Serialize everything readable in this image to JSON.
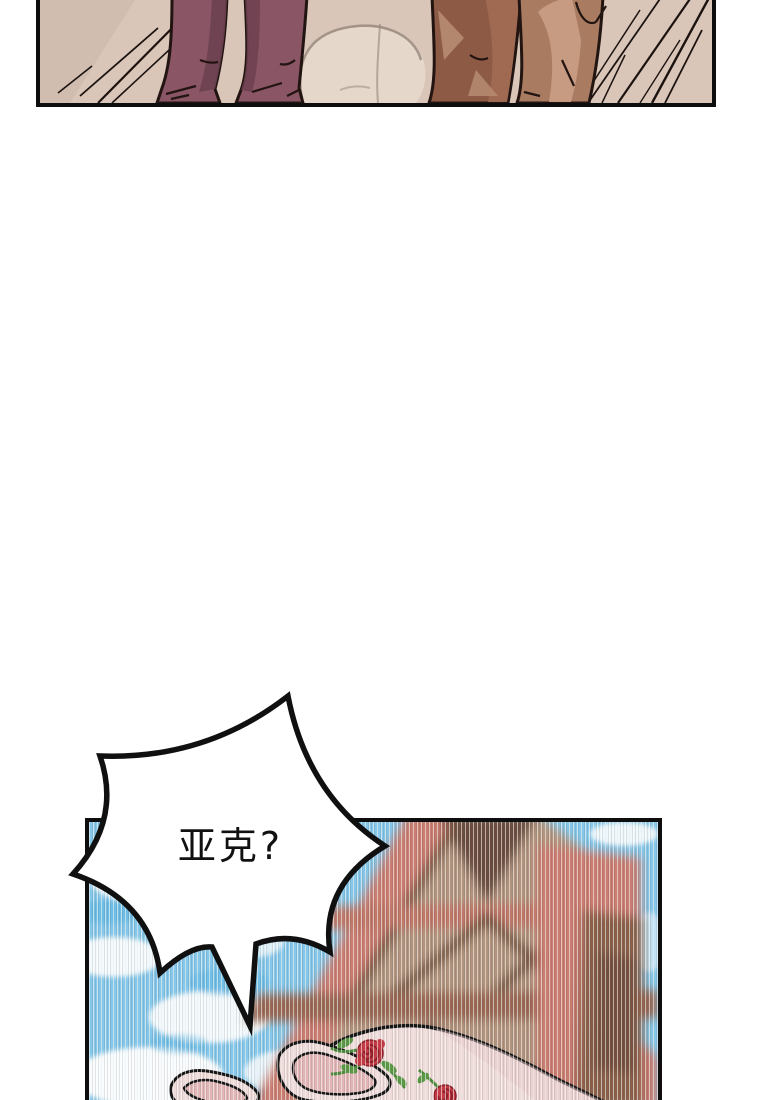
{
  "page": {
    "kind": "webtoon comic page",
    "background": "#ffffff"
  },
  "speech_bubble": {
    "text": "亚克?",
    "shape": "spiky-burst",
    "fill": "#ffffff",
    "stroke": "#101010",
    "text_color": "#111111"
  },
  "panels": {
    "top": {
      "description": "legs of two characters standing on a stone street with speed lines",
      "border_color": "#0e0e0e",
      "colors": {
        "ground": "#d9c6b9",
        "ground_shade": "#cbb6a8",
        "stone_light": "#e7d8cb",
        "crack": "#95867a",
        "outline": "#221411",
        "left_pants": "#8a5565",
        "left_pants_shadow": "#6c4150",
        "right_leg_front": "#8d5a45",
        "right_leg_front_light": "#a06b52",
        "right_leg_back": "#a97c62",
        "right_leg_highlight": "#c79d83",
        "speed_line": "#1c1310"
      }
    },
    "bottom": {
      "description": "blue sky, blurred half-timbered gable roof, rose-patterned bonnet",
      "border_color": "#0e0e0e",
      "colors": {
        "sky": "#85c8ea",
        "sky_deep": "#58b4e2",
        "cloud": "#ffffff",
        "roof_salmon": "#ca7d6f",
        "roof_band": "#bf7868",
        "timber_dark": "#6b4c3c",
        "timber_beam": "#775741",
        "gable_infill": "#b2947e",
        "band_lower": "#996753",
        "wing_brown": "#8a6049",
        "bonnet": "#efdbda",
        "bonnet_inner": "#e2b6b6",
        "outline": "#151515",
        "rose": "#c63b45",
        "rose_line": "#8e1f28",
        "leaf": "#4d8c3c"
      }
    }
  }
}
